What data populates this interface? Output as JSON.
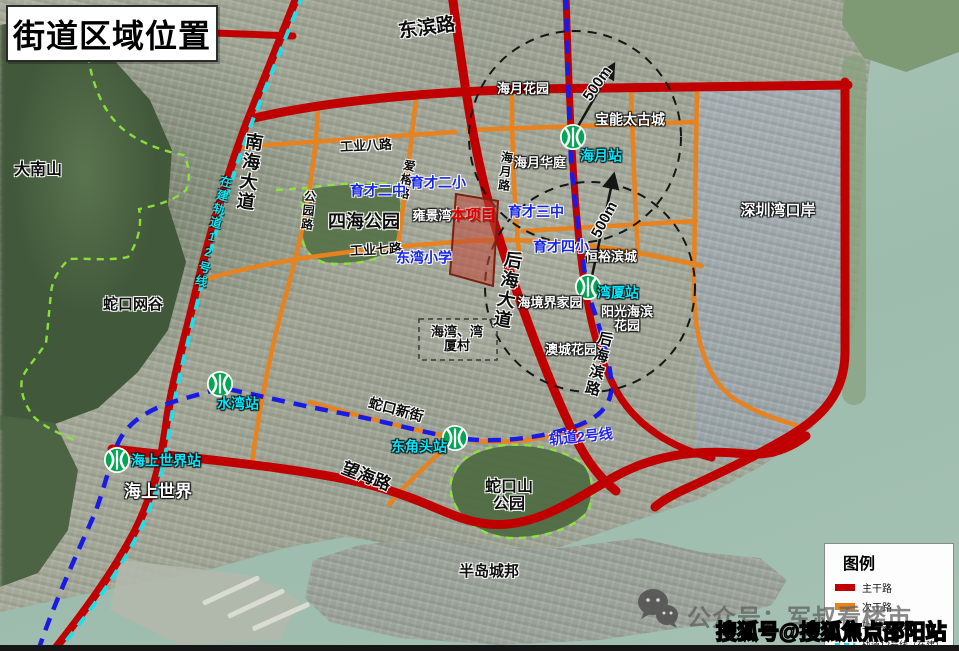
{
  "title": "街道区域位置",
  "colors": {
    "main_road": "#c00000",
    "secondary_road": "#e8821e",
    "metro_line2_blue": "#1a1ae6",
    "metro_line12_cyan": "#1ce0ea",
    "station_green": "#00a651",
    "school_label_blue": "#1423e8",
    "station_label_cyan": "#00eaff",
    "project_red": "#e00000"
  },
  "legend": {
    "title": "图例",
    "items": [
      {
        "id": "main-road",
        "label": "主干路",
        "swatch": "solid",
        "color": "#c00000"
      },
      {
        "id": "secondary-road",
        "label": "次干路",
        "swatch": "solid",
        "color": "#e8821e"
      },
      {
        "id": "metro-line-2",
        "label": "轨道2号线",
        "swatch": "dashed",
        "color": "#1a1ae6"
      },
      {
        "id": "metro-line-12",
        "label": "轨道12号线（在建）",
        "swatch": "dashed",
        "color": "#1ce0ea"
      }
    ]
  },
  "watermarks": {
    "wechat_text": "公众号：军叔看楼市",
    "sohu_text": "搜狐号@搜狐焦点邵阳站"
  },
  "map": {
    "stations": [
      {
        "id": "haiyue",
        "x": 573,
        "y": 137
      },
      {
        "id": "wanxia",
        "x": 588,
        "y": 287
      },
      {
        "id": "shuiwan",
        "x": 220,
        "y": 384
      },
      {
        "id": "dongjiaotou",
        "x": 455,
        "y": 438
      },
      {
        "id": "sea-world",
        "x": 117,
        "y": 460
      }
    ],
    "labels": [
      {
        "id": "dongbin-road",
        "text": "东滨路",
        "x": 427,
        "y": 29,
        "fs": 19,
        "cls": "road",
        "rot": -8
      },
      {
        "id": "nanhai-avenue",
        "text": "南海大道",
        "x": 249,
        "y": 172,
        "fs": 18,
        "cls": "road",
        "rot": 8,
        "vert": true
      },
      {
        "id": "houhai-avenue",
        "text": "后海大道",
        "x": 507,
        "y": 290,
        "fs": 18,
        "cls": "road",
        "rot": 10,
        "vert": true
      },
      {
        "id": "houhaibin-road",
        "text": "后海滨路",
        "x": 598,
        "y": 364,
        "fs": 15,
        "cls": "road",
        "rot": 14,
        "vert": true
      },
      {
        "id": "wanghai-road",
        "text": "望海路",
        "x": 366,
        "y": 477,
        "fs": 17,
        "cls": "road",
        "rot": 21
      },
      {
        "id": "shekou-new-street",
        "text": "蛇口新街",
        "x": 396,
        "y": 410,
        "fs": 14,
        "cls": "road",
        "rot": 15
      },
      {
        "id": "gongye-8-road",
        "text": "工业八路",
        "x": 366,
        "y": 146,
        "fs": 13,
        "cls": "road",
        "rot": -3
      },
      {
        "id": "gongye-7-road",
        "text": "工业七路",
        "x": 376,
        "y": 250,
        "fs": 13,
        "cls": "road",
        "rot": -3
      },
      {
        "id": "gongyuan-road",
        "text": "公园路",
        "x": 308,
        "y": 211,
        "fs": 12,
        "cls": "road",
        "rot": 6,
        "vert": true
      },
      {
        "id": "airong-road",
        "text": "爱榕路",
        "x": 406,
        "y": 180,
        "fs": 12,
        "cls": "road",
        "rot": 12,
        "vert": true
      },
      {
        "id": "haiyue-road",
        "text": "海月路",
        "x": 505,
        "y": 172,
        "fs": 12,
        "cls": "road",
        "rot": 6,
        "vert": true
      },
      {
        "id": "danan-mountain",
        "text": "大南山",
        "x": 38,
        "y": 170,
        "fs": 16,
        "cls": "place"
      },
      {
        "id": "shekou-net-valley",
        "text": "蛇口网谷",
        "x": 133,
        "y": 305,
        "fs": 15,
        "cls": "place"
      },
      {
        "id": "sihai-park",
        "text": "四海公园",
        "x": 364,
        "y": 222,
        "fs": 18,
        "cls": "place"
      },
      {
        "id": "shekoushan-park",
        "text": "蛇口山\n公园",
        "x": 509,
        "y": 496,
        "fs": 16,
        "cls": "place"
      },
      {
        "id": "bandao-chengbang",
        "text": "半岛城邦",
        "x": 489,
        "y": 572,
        "fs": 15,
        "cls": "place"
      },
      {
        "id": "haiwan-wanxia-village",
        "text": "海湾、湾\n厦村",
        "x": 457,
        "y": 339,
        "fs": 13,
        "cls": "place"
      },
      {
        "id": "haiyue-garden",
        "text": "海月花园",
        "x": 523,
        "y": 89,
        "fs": 13,
        "cls": "white"
      },
      {
        "id": "baoneng-taikoo-city",
        "text": "宝能太古城",
        "x": 630,
        "y": 120,
        "fs": 14,
        "cls": "white"
      },
      {
        "id": "haiyue-huating",
        "text": "海月华庭",
        "x": 540,
        "y": 163,
        "fs": 13,
        "cls": "white"
      },
      {
        "id": "yongjingwan",
        "text": "雍景湾",
        "x": 432,
        "y": 216,
        "fs": 13,
        "cls": "white"
      },
      {
        "id": "hengyu-bincheng",
        "text": "恒裕滨城",
        "x": 611,
        "y": 257,
        "fs": 13,
        "cls": "white"
      },
      {
        "id": "haijingjie-jiayuan",
        "text": "海境界家园",
        "x": 550,
        "y": 303,
        "fs": 13,
        "cls": "white"
      },
      {
        "id": "yangguang-haibin-garden",
        "text": "阳光海滨\n花园",
        "x": 627,
        "y": 319,
        "fs": 13,
        "cls": "white"
      },
      {
        "id": "aocheng-garden",
        "text": "澳城花园",
        "x": 571,
        "y": 350,
        "fs": 13,
        "cls": "white"
      },
      {
        "id": "shenzhen-bay-port",
        "text": "深圳湾口岸",
        "x": 778,
        "y": 211,
        "fs": 15,
        "cls": "white"
      },
      {
        "id": "sea-world",
        "text": "海上世界",
        "x": 158,
        "y": 492,
        "fs": 17,
        "cls": "white"
      },
      {
        "id": "yucai-2-middle-school",
        "text": "育才二中",
        "x": 378,
        "y": 191,
        "fs": 14,
        "cls": "school"
      },
      {
        "id": "yucai-2-primary-school",
        "text": "育才二小",
        "x": 438,
        "y": 183,
        "fs": 14,
        "cls": "school"
      },
      {
        "id": "yucai-3-middle-school",
        "text": "育才三中",
        "x": 536,
        "y": 212,
        "fs": 14,
        "cls": "school"
      },
      {
        "id": "yucai-4-primary-school",
        "text": "育才四小",
        "x": 561,
        "y": 247,
        "fs": 14,
        "cls": "school"
      },
      {
        "id": "dongwan-primary-school",
        "text": "东湾小学",
        "x": 424,
        "y": 258,
        "fs": 14,
        "cls": "school"
      },
      {
        "id": "haiyue-station",
        "text": "海月站",
        "x": 601,
        "y": 156,
        "fs": 14,
        "cls": "station"
      },
      {
        "id": "wanxia-station",
        "text": "湾厦站",
        "x": 618,
        "y": 293,
        "fs": 14,
        "cls": "station"
      },
      {
        "id": "shuiwan-station",
        "text": "水湾站",
        "x": 238,
        "y": 404,
        "fs": 14,
        "cls": "station"
      },
      {
        "id": "dongjiaotou-station",
        "text": "东角头站",
        "x": 419,
        "y": 447,
        "fs": 14,
        "cls": "station"
      },
      {
        "id": "sea-world-station",
        "text": "海上世界站",
        "x": 166,
        "y": 461,
        "fs": 14,
        "cls": "station"
      },
      {
        "id": "metro-line-2",
        "text": "轨道2号线",
        "x": 581,
        "y": 437,
        "fs": 14,
        "cls": "line2",
        "rot": -6
      },
      {
        "id": "metro-line-12-under-construction",
        "text": "在建轨道12号线",
        "x": 213,
        "y": 232,
        "fs": 12,
        "cls": "line12",
        "rot": 14,
        "vert": true
      },
      {
        "id": "project-site",
        "text": "本项目",
        "x": 473,
        "y": 216,
        "fs": 15,
        "cls": "project"
      },
      {
        "id": "radius-500m-north",
        "text": "500m",
        "x": 598,
        "y": 84,
        "fs": 15,
        "cls": "r500",
        "rot": -55
      },
      {
        "id": "radius-500m-south",
        "text": "500m",
        "x": 605,
        "y": 220,
        "fs": 15,
        "cls": "r500",
        "rot": -62
      }
    ]
  }
}
